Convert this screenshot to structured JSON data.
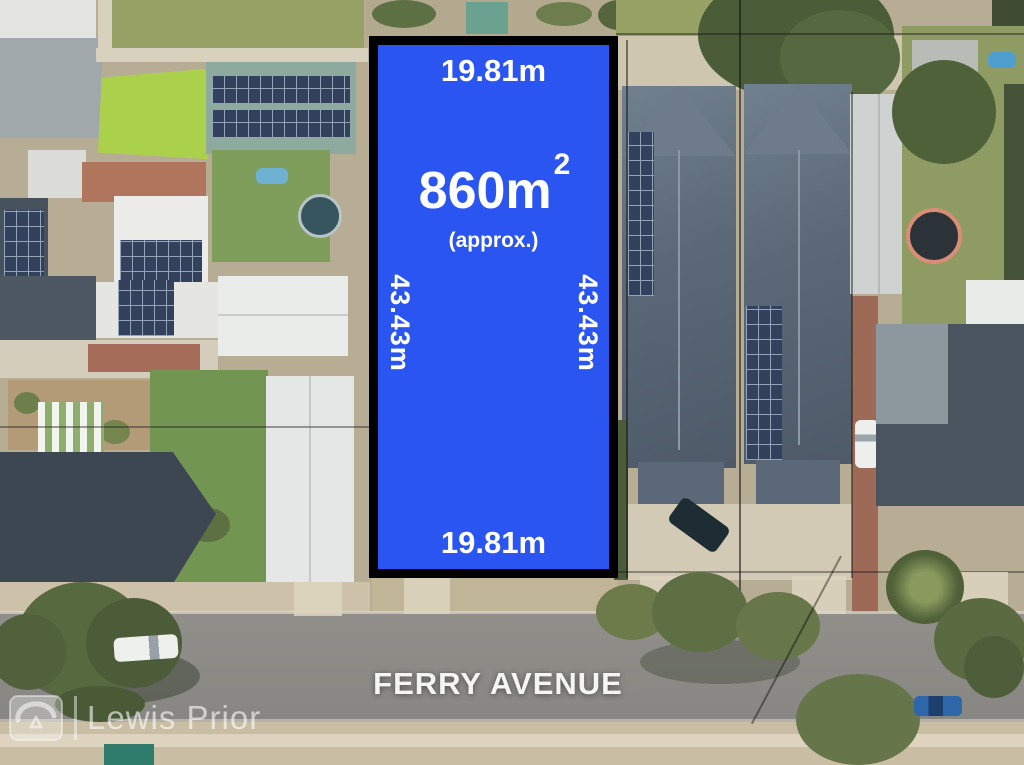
{
  "colors": {
    "parcel_fill": "#2a55f0",
    "parcel_border": "#000000",
    "label_text": "#ffffff",
    "street_text": "#f5f5f3"
  },
  "parcel": {
    "top_dim": "19.81m",
    "bottom_dim": "19.81m",
    "left_dim": "43.43m",
    "right_dim": "43.43m",
    "area_value": "860m",
    "area_sup": "2",
    "area_note": "(approx.)"
  },
  "street": {
    "name": "FERRY AVENUE"
  },
  "watermark": {
    "brand": "Lewis Prior",
    "logo_icon": "lewis-prior-logo"
  }
}
